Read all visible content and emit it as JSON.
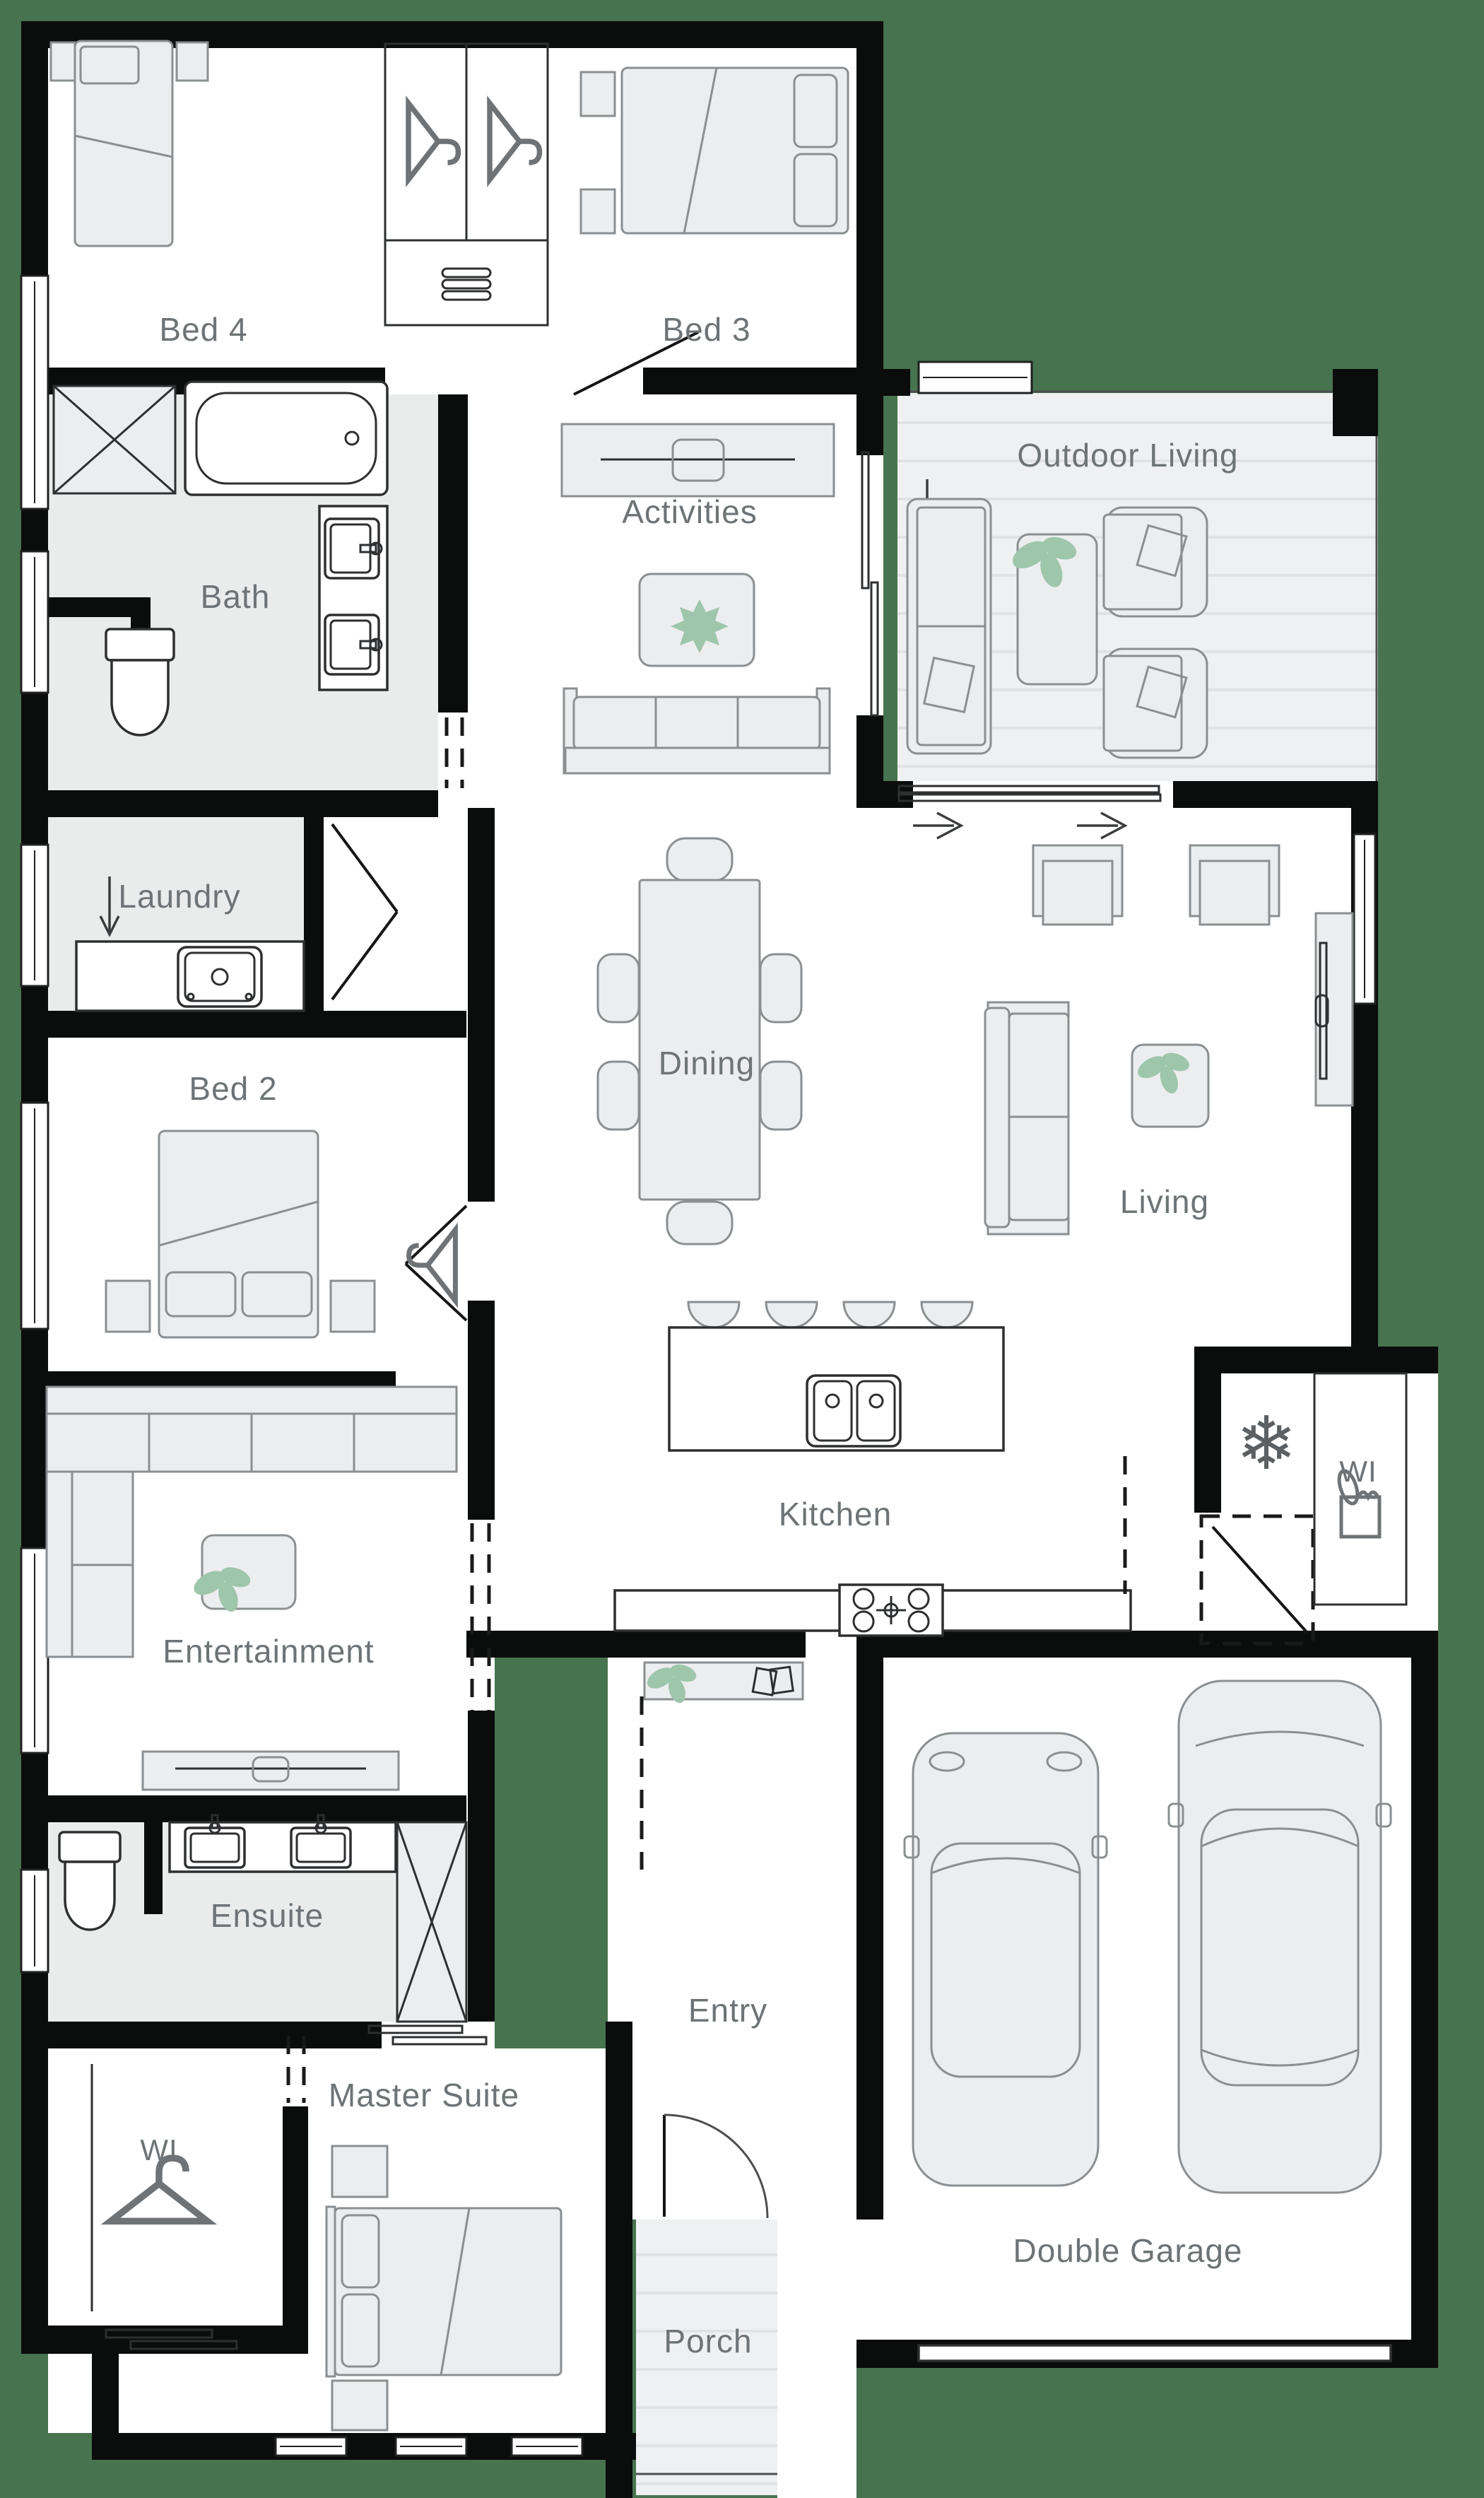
{
  "palette": {
    "background": "#47734F",
    "wall": "#0b0c0c",
    "floor": "#ffffff",
    "wet_floor": "#eaecec",
    "deck": "#eff0f1",
    "deck_stripe": "#e0e2e3",
    "furniture_fill": "#ecedee",
    "furniture_stroke": "#8b8f91",
    "fixture_stroke": "#2e2f30",
    "label": "#6e7376",
    "plant": "#9dc6ab",
    "dash": "#1a1a1a"
  },
  "rooms": {
    "bed4": {
      "label": "Bed 4"
    },
    "bed3": {
      "label": "Bed 3"
    },
    "bath": {
      "label": "Bath"
    },
    "activities": {
      "label": "Activities"
    },
    "outdoor_living": {
      "label": "Outdoor Living"
    },
    "laundry": {
      "label": "Laundry"
    },
    "bed2": {
      "label": "Bed 2"
    },
    "dining": {
      "label": "Dining"
    },
    "living": {
      "label": "Living"
    },
    "kitchen": {
      "label": "Kitchen"
    },
    "pantry": {
      "label": "WI"
    },
    "entertainment": {
      "label": "Entertainment"
    },
    "ensuite": {
      "label": "Ensuite"
    },
    "entry": {
      "label": "Entry"
    },
    "master_suite": {
      "label": "Master Suite"
    },
    "walk_in_robe": {
      "label": "WI"
    },
    "double_garage": {
      "label": "Double Garage"
    },
    "porch": {
      "label": "Porch"
    }
  },
  "icons": {
    "fridge_glyph": "❄",
    "fridge_space": "snowflake-icon",
    "wardrobe": "hanger-icon",
    "pantry_goods": "grocery-icon",
    "plant": "plant-icon",
    "entry_flow": "arrow-icon"
  }
}
